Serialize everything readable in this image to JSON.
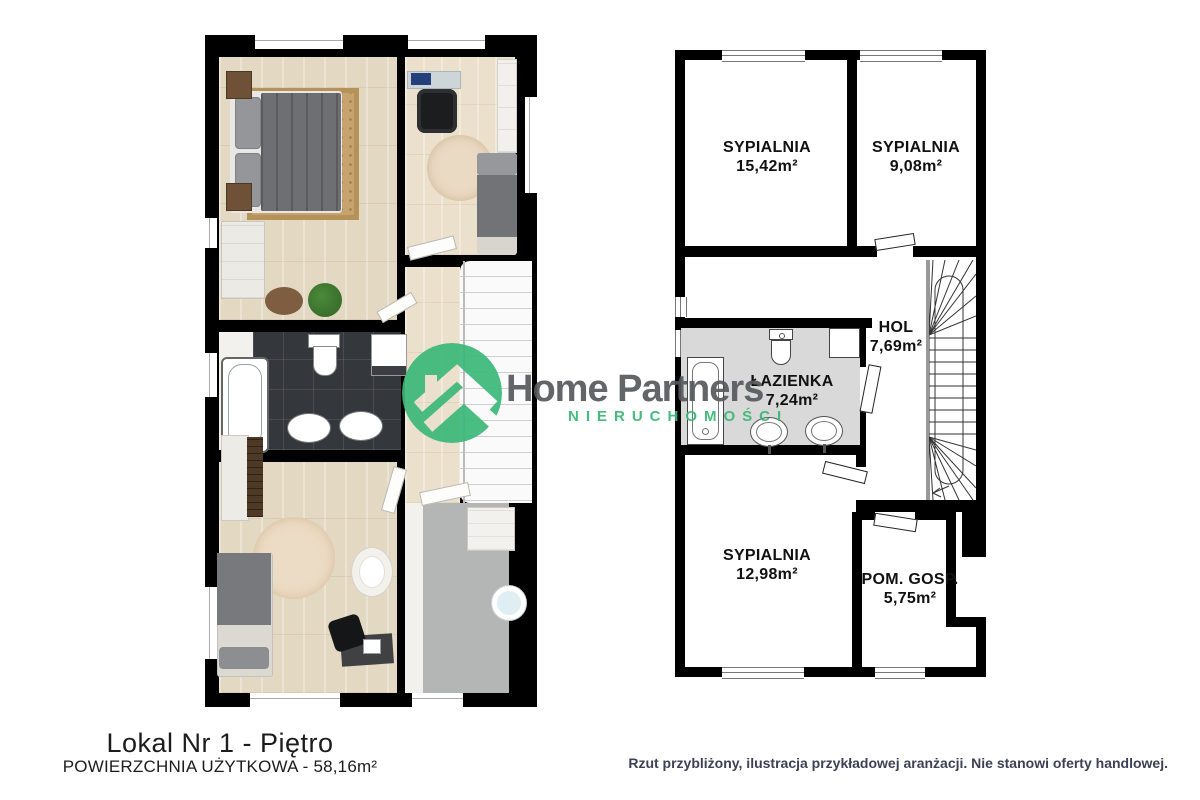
{
  "brand": {
    "name": "Home Partners",
    "tagline": "NIERUCHOMOŚCI"
  },
  "colors": {
    "accent_green": "#3cb878",
    "brand_gray": "#58595b",
    "wall_black": "#000000",
    "bath_gray": "#d9d9d9",
    "disclaimer_text": "#3d4155"
  },
  "plan_2d": {
    "rooms": [
      {
        "id": "sypialnia-1",
        "name": "SYPIALNIA",
        "area": "15,42m²"
      },
      {
        "id": "sypialnia-2",
        "name": "SYPIALNIA",
        "area": "9,08m²"
      },
      {
        "id": "hol",
        "name": "HOL",
        "area": "7,69m²"
      },
      {
        "id": "lazienka",
        "name": "ŁAZIENKA",
        "area": "7,24m²"
      },
      {
        "id": "sypialnia-3",
        "name": "SYPIALNIA",
        "area": "12,98m²"
      },
      {
        "id": "pom-gosp",
        "name": "POM. GOSP.",
        "area": "5,75m²"
      }
    ]
  },
  "footer": {
    "title": "Lokal Nr 1 - Piętro",
    "subtitle": "POWIERZCHNIA UŻYTKOWA - 58,16m²"
  },
  "disclaimer": "Rzut przybliżony, ilustracja przykładowej aranżacji. Nie stanowi oferty handlowej."
}
